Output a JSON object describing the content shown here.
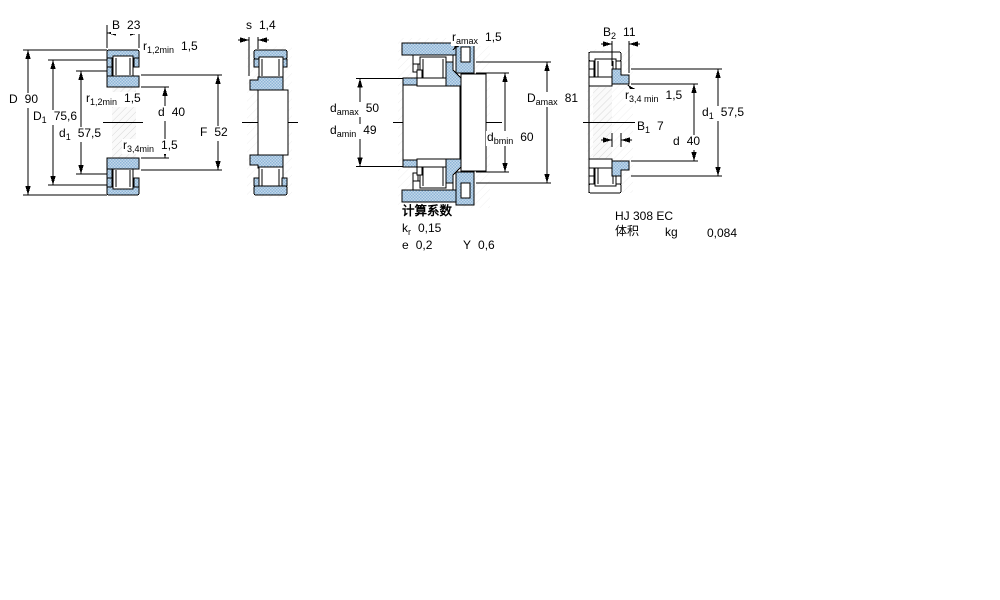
{
  "meta": {
    "document_type": "bearing dimension drawing",
    "bearing_designation_shown": "HJ 308 EC"
  },
  "colors": {
    "part_blue": "#9fc0dc",
    "part_blue_light": "#cfe0ef",
    "outline": "#000000",
    "hatch_gray": "#dcdcdc",
    "background": "#ffffff"
  },
  "labels": {
    "b23": {
      "main": "B",
      "sub": "",
      "value": "23"
    },
    "r12_top": {
      "main": "r",
      "sub": "1,2min",
      "value": "1,5"
    },
    "D90": {
      "main": "D",
      "sub": "",
      "value": "90"
    },
    "D1": {
      "main": "D",
      "sub": "1",
      "value": "75,6"
    },
    "d1_left": {
      "main": "d",
      "sub": "1",
      "value": "57,5"
    },
    "r12_mid": {
      "main": "r",
      "sub": "1,2min",
      "value": "1,5"
    },
    "r34_left": {
      "main": "r",
      "sub": "3,4min",
      "value": "1,5"
    },
    "d40_left": {
      "main": "d",
      "sub": "",
      "value": "40"
    },
    "F52": {
      "main": "F",
      "sub": "",
      "value": "52"
    },
    "s14": {
      "main": "s",
      "sub": "",
      "value": "1,4"
    },
    "r_amax": {
      "main": "r",
      "sub": "amax",
      "value": "1,5"
    },
    "d_amax": {
      "main": "d",
      "sub": "amax",
      "value": "50"
    },
    "d_amin": {
      "main": "d",
      "sub": "amin",
      "value": "49"
    },
    "D_amax": {
      "main": "D",
      "sub": "amax",
      "value": "81"
    },
    "d_bmin": {
      "main": "d",
      "sub": "bmin",
      "value": "60"
    },
    "B2": {
      "main": "B",
      "sub": "2",
      "value": "11"
    },
    "r34_right": {
      "main": "r",
      "sub": "3,4 min",
      "value": "1,5"
    },
    "B1": {
      "main": "B",
      "sub": "1",
      "value": "7"
    },
    "d40_right": {
      "main": "d",
      "sub": "",
      "value": "40"
    },
    "d1_right": {
      "main": "d",
      "sub": "1",
      "value": "57,5"
    },
    "kr": {
      "main": "k",
      "sub": "r",
      "value": "0,15"
    },
    "e": {
      "main": "e",
      "sub": "",
      "value": "0,2"
    },
    "Y": {
      "main": "Y",
      "sub": "",
      "value": "0,6"
    }
  },
  "texts": {
    "calc_title": "计算系数",
    "part_name": "HJ 308 EC",
    "volume_label": "体积",
    "unit_label": "kg",
    "mass_value": "0,084"
  }
}
